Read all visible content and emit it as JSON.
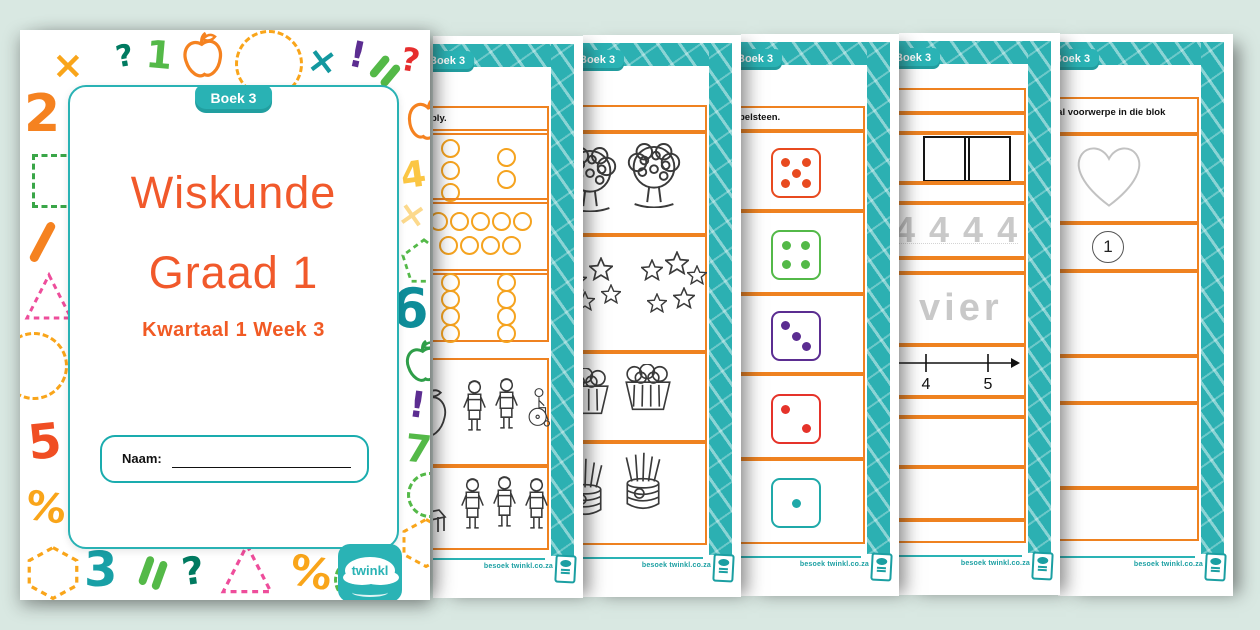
{
  "app": {
    "background": "#d9e8e2"
  },
  "colors": {
    "teal": "#29b2b4",
    "orange_box": "#ef8220",
    "title_orange": "#f1592b",
    "subtitle_orange": "#f15a24",
    "dot_outline": "#f5a31f",
    "mint_bg": "#d9e8e2"
  },
  "cover": {
    "badge": "Boek 3",
    "title_line1": "Wiskunde",
    "title_line2": "Graad 1",
    "subtitle": "Kwartaal 1 Week 3",
    "name_label": "Naam:",
    "logo_text": "twinkl",
    "decorations": [
      {
        "t": "g",
        "g": "×",
        "c": "#f9a51a",
        "x": 32,
        "y": 16,
        "s": 38
      },
      {
        "t": "g",
        "g": "?",
        "c": "#007a60",
        "x": 96,
        "y": 12,
        "s": 30,
        "r": -10
      },
      {
        "t": "g",
        "g": "1",
        "c": "#54b948",
        "x": 126,
        "y": 6,
        "s": 38,
        "r": 5
      },
      {
        "t": "apple",
        "c": "#f58220",
        "x": 160,
        "y": 2,
        "s": 46,
        "r": -5
      },
      {
        "t": "circle",
        "c": "#f9a51a",
        "x": 215,
        "y": 0,
        "s": 62
      },
      {
        "t": "g",
        "g": "×",
        "c": "#13989f",
        "x": 287,
        "y": 14,
        "s": 36,
        "r": 8
      },
      {
        "t": "g",
        "g": "!",
        "c": "#5c2d91",
        "x": 329,
        "y": 8,
        "s": 36,
        "r": 12
      },
      {
        "t": "bars",
        "c": "#54b948",
        "x": 354,
        "y": 28,
        "s": 26,
        "r": 40
      },
      {
        "t": "g",
        "g": "?",
        "c": "#e62e2e",
        "x": 381,
        "y": 14,
        "s": 32,
        "r": 10
      },
      {
        "t": "g",
        "g": "2",
        "c": "#f58220",
        "x": 4,
        "y": 58,
        "s": 52
      },
      {
        "t": "square",
        "c": "#3aa648",
        "x": 12,
        "y": 124,
        "s": 48
      },
      {
        "t": "slash",
        "c": "#f58220",
        "x": 18,
        "y": 190,
        "s": 44,
        "r": 28
      },
      {
        "t": "triangle",
        "c": "#ee4d9b",
        "x": 4,
        "y": 242,
        "s": 50
      },
      {
        "t": "circle",
        "c": "#f9a51a",
        "x": -20,
        "y": 302,
        "s": 62
      },
      {
        "t": "g",
        "g": "5",
        "c": "#f04e23",
        "x": 8,
        "y": 388,
        "s": 48,
        "r": -6
      },
      {
        "t": "g",
        "g": "%",
        "c": "#f9a51a",
        "x": 6,
        "y": 458,
        "s": 40,
        "r": 8
      },
      {
        "t": "hexagon",
        "c": "#f9a51a",
        "x": 6,
        "y": 516,
        "s": 54
      },
      {
        "t": "g",
        "g": "3",
        "c": "#18a0a6",
        "x": 64,
        "y": 516,
        "s": 48
      },
      {
        "t": "bars",
        "c": "#54b948",
        "x": 122,
        "y": 528,
        "s": 30,
        "r": 20
      },
      {
        "t": "g",
        "g": "?",
        "c": "#007a60",
        "x": 162,
        "y": 522,
        "s": 38,
        "r": -8
      },
      {
        "t": "triangle",
        "c": "#ee4d9b",
        "x": 200,
        "y": 512,
        "s": 54
      },
      {
        "t": "g",
        "g": "%",
        "c": "#f9a51a",
        "x": 270,
        "y": 522,
        "s": 42,
        "r": 10
      },
      {
        "t": "circle",
        "c": "#54b948",
        "x": 314,
        "y": 528,
        "s": 38
      },
      {
        "t": "apple",
        "c": "#f58220",
        "x": 384,
        "y": 66,
        "s": 44,
        "r": 10
      },
      {
        "t": "g",
        "g": "4",
        "c": "#fbc643",
        "x": 381,
        "y": 128,
        "s": 36,
        "r": -8
      },
      {
        "t": "g",
        "g": "×",
        "c": "#fcd98c",
        "x": 378,
        "y": 168,
        "s": 34,
        "r": 10
      },
      {
        "t": "pentagon",
        "c": "#54b948",
        "x": 381,
        "y": 208,
        "s": 46
      },
      {
        "t": "g",
        "g": "6",
        "c": "#0e8d99",
        "x": 371,
        "y": 252,
        "s": 54
      },
      {
        "t": "apple",
        "c": "#2f9e49",
        "x": 383,
        "y": 310,
        "s": 42,
        "r": -6
      },
      {
        "t": "g",
        "g": "!",
        "c": "#5c2d91",
        "x": 389,
        "y": 358,
        "s": 36,
        "r": 8
      },
      {
        "t": "g",
        "g": "7",
        "c": "#54b948",
        "x": 385,
        "y": 400,
        "s": 38,
        "r": 6
      },
      {
        "t": "circle",
        "c": "#54b948",
        "x": 387,
        "y": 442,
        "s": 40
      },
      {
        "t": "hexagon",
        "c": "#f9a51a",
        "x": 381,
        "y": 488,
        "s": 50
      }
    ]
  },
  "worksheets": [
    {
      "badge": "Boek 3",
      "instruction": "bly.",
      "footer": "besoek twinkl.co.za",
      "kind": "dots",
      "dot_groups": [
        [
          3,
          2
        ],
        [
          5,
          4
        ],
        [
          4,
          4
        ]
      ],
      "figure_rows": [
        [
          "apple",
          "child",
          "child",
          "wheelchair"
        ],
        [
          "chair",
          "child",
          "child",
          "child"
        ]
      ]
    },
    {
      "badge": "Boek 3",
      "instruction": "",
      "footer": "besoek twinkl.co.za",
      "kind": "objects",
      "rows": [
        {
          "type": "tree",
          "count": 2
        },
        {
          "type": "stars",
          "clusters": [
            4,
            5
          ]
        },
        {
          "type": "basket",
          "count": 2
        },
        {
          "type": "can",
          "count": 2
        }
      ]
    },
    {
      "badge": "Boek 3",
      "instruction": "belsteen.",
      "footer": "besoek twinkl.co.za",
      "kind": "dice",
      "dice": [
        {
          "value": 5,
          "color": "#e84a1f"
        },
        {
          "value": 4,
          "color": "#53b948"
        },
        {
          "value": 3,
          "color": "#5b2d91"
        },
        {
          "value": 2,
          "color": "#e5332a"
        },
        {
          "value": 1,
          "color": "#1fa9a9"
        }
      ]
    },
    {
      "badge": "Boek 3",
      "instruction": "",
      "footer": "besoek twinkl.co.za",
      "kind": "tracing",
      "trace_digits": "4 4 4 4",
      "trace_word": "vier",
      "numberline_labels": [
        "4",
        "5"
      ]
    },
    {
      "badge": "Boek 3",
      "instruction": "tal voorwerpe in die blok",
      "footer": "besoek twinkl.co.za",
      "kind": "count-shape",
      "shape": "heart",
      "answer": "1"
    }
  ]
}
